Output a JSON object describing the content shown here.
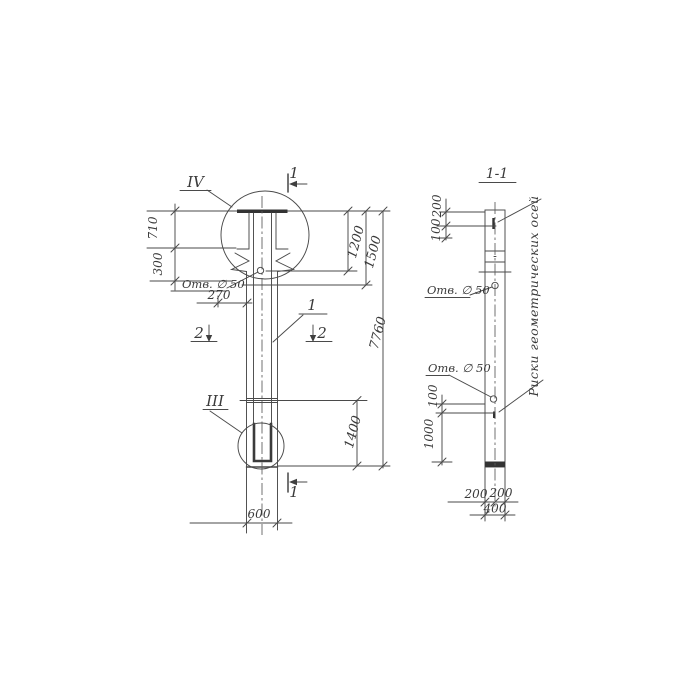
{
  "main_view": {
    "detail_top_label": "IV",
    "detail_bottom_label": "III",
    "part_callout": "1",
    "section_mark_top": "1",
    "section_mark_bottom": "1",
    "section_mark_left": "2",
    "section_mark_right": "2",
    "hole_label": "Отв. ∅ 50",
    "dims": {
      "d710": "710",
      "d300": "300",
      "d270": "270",
      "d1200": "1200",
      "d1500": "1500",
      "d7760": "7760",
      "d1400": "1400",
      "d600": "600"
    }
  },
  "section_view": {
    "title": "1-1",
    "hole_label_top": "Отв. ∅ 50",
    "hole_label_bottom": "Отв. ∅ 50",
    "axis_note": "Риски геометрических осей",
    "dims": {
      "top_200": "200",
      "top_100": "100",
      "mid_100": "100",
      "mid_1000": "1000",
      "bottom_200_left": "200",
      "bottom_200_right": "200",
      "bottom_400": "400"
    }
  },
  "colors": {
    "line": "#4a4a4a",
    "text": "#3a3a3a",
    "background": "#ffffff"
  }
}
